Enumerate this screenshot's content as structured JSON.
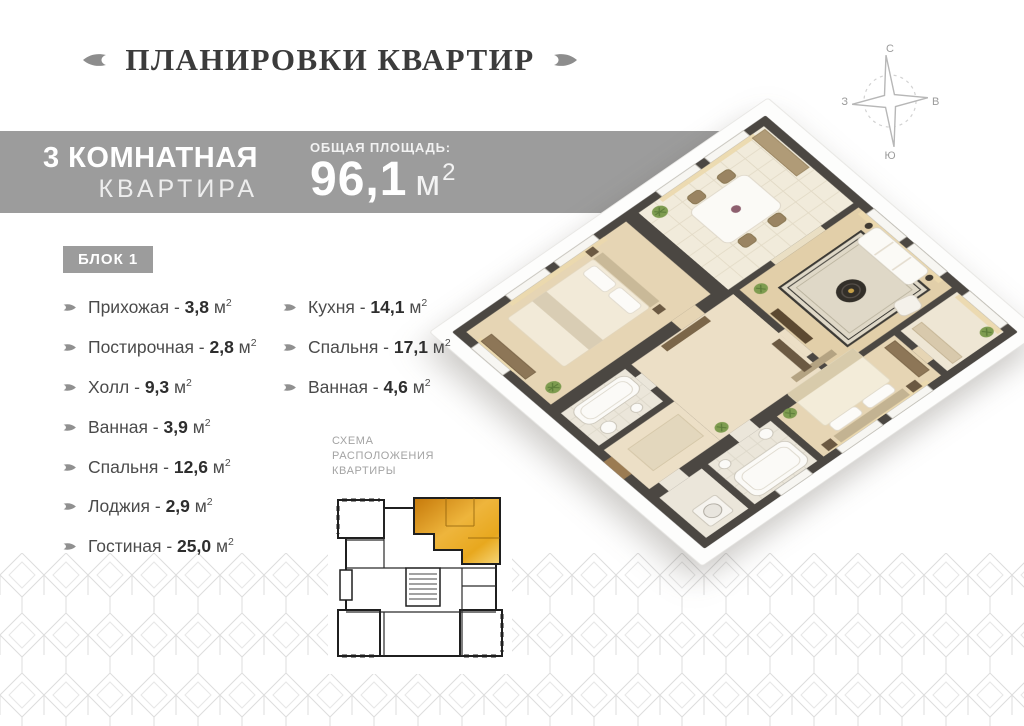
{
  "title": "ПЛАНИРОВКИ КВАРТИР",
  "banner": {
    "type_line1": "3 КОМНАТНАЯ",
    "type_line2": "КВАРТИРА",
    "area_label": "ОБЩАЯ ПЛОЩАДЬ:",
    "area_value": "96,1",
    "area_unit": "м",
    "area_unit_sup": "2"
  },
  "block_label": "БЛОК 1",
  "unit": {
    "symbol": "м",
    "sup": "2",
    "separator": " - "
  },
  "room_columns": {
    "left": [
      {
        "label": "Прихожая",
        "area": "3,8"
      },
      {
        "label": "Постирочная",
        "area": "2,8"
      },
      {
        "label": "Холл",
        "area": "9,3"
      },
      {
        "label": "Ванная",
        "area": "3,9"
      },
      {
        "label": "Спальня",
        "area": "12,6"
      },
      {
        "label": "Лоджия",
        "area": "2,9"
      },
      {
        "label": "Гостиная",
        "area": "25,0"
      }
    ],
    "right": [
      {
        "label": "Кухня",
        "area": "14,1"
      },
      {
        "label": "Спальня",
        "area": "17,1"
      },
      {
        "label": "Ванная",
        "area": "4,6"
      }
    ]
  },
  "compass": {
    "north": "С",
    "east": "В",
    "west": "З",
    "south": "Ю"
  },
  "schema_label_lines": [
    "СХЕМА",
    "РАСПОЛОЖЕНИЯ",
    "КВАРТИРЫ"
  ],
  "colors": {
    "banner_bg": "#9c9c9c",
    "accent_gold": "#e8a81e",
    "wall_dark": "#4b4742",
    "pattern_line": "#dddddd",
    "title_text": "#3b3b3b"
  }
}
